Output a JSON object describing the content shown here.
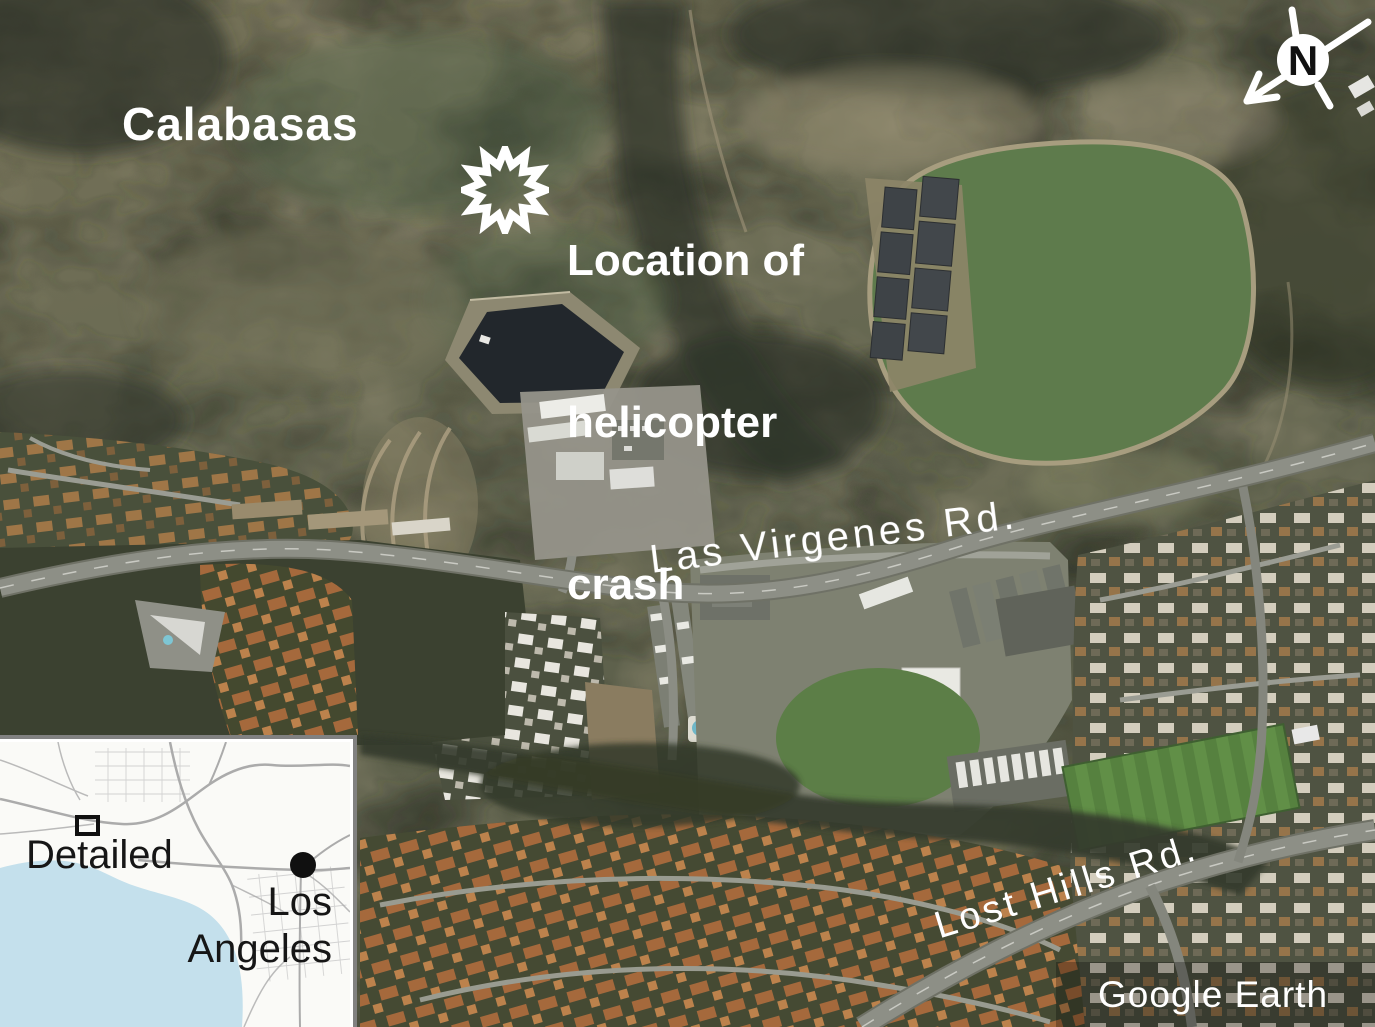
{
  "map": {
    "labels": {
      "region": "Calabasas",
      "crash": {
        "lines": [
          "Location of",
          "helicopter",
          "crash"
        ]
      },
      "road_las_virgenes": "Las Virgenes Rd.",
      "road_lost_hills": "Lost Hills Rd."
    },
    "compass": {
      "letter": "N"
    },
    "attribution": "Google Earth"
  },
  "inset": {
    "area_marker_label": "Detailed",
    "city": {
      "lines": [
        "Los",
        "Angeles"
      ]
    }
  },
  "colors": {
    "label_text": "#ffffff",
    "inset_text": "#161616",
    "ocean": "#c4e0ec",
    "terrain_base": "#6a6a54",
    "pasture_green": "#5e7b4c",
    "reservoir_water": "#22272c",
    "road_gray": "#8d8f86",
    "roof_orange": "#a5693c",
    "attribution_band": "rgba(0,0,0,0.27)"
  }
}
